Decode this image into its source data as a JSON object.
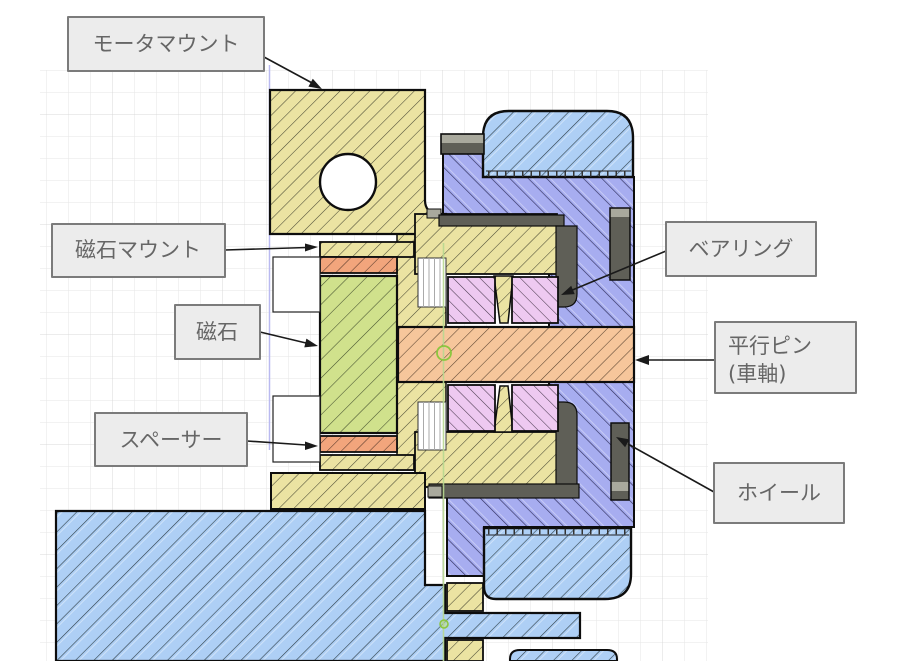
{
  "drawing": {
    "kind": "CAD cross-section drawing with callout labels",
    "view": "section view of a motor-driven wheel assembly"
  },
  "labels": {
    "motor_mount": {
      "text": "モータマウント"
    },
    "magnet_mount": {
      "text": "磁石マウント"
    },
    "magnet": {
      "text": "磁石"
    },
    "spacer": {
      "text": "スペーサー"
    },
    "bearing": {
      "text": "ベアリング"
    },
    "pin": {
      "line1": "平行ピン",
      "line2": "(車軸)"
    },
    "wheel": {
      "text": "ホイール"
    }
  },
  "parts": [
    {
      "label": "モータマウント",
      "color": "#ebe3a2"
    },
    {
      "label": "磁石マウント",
      "color": "#ebe3a2"
    },
    {
      "label": "磁石",
      "color": "#d0e18c"
    },
    {
      "label": "スペーサー",
      "color": "#f2a57c"
    },
    {
      "label": "ベアリング",
      "color": "#eec9f1"
    },
    {
      "label": "平行ピン (車軸)",
      "color": "#f6c69b"
    },
    {
      "label": "ホイール",
      "color": "#a7adf0"
    }
  ],
  "colors": {
    "motor_mount_yellow": "#ebe3a2",
    "magnet_green": "#d0e18c",
    "spacer_salmon": "#f2a57c",
    "pin_orange": "#f6c69b",
    "bearing_pink": "#eec9f1",
    "wheel_hub_purple": "#a7adf0",
    "tire_blue": "#aecff5",
    "hardware_dark": "#5f5f57",
    "hardware_light": "#a9a99d",
    "label_box_fill": "#ececec",
    "label_box_border": "#7b7b7b",
    "label_text": "#666666",
    "leader_line": "#1a1a1a",
    "grid_line": "#e6e6e6",
    "grid_major": "#d8d8d8",
    "sketch_line_blue": "#b9b9f0",
    "highlight_green": "#8cc63f"
  }
}
